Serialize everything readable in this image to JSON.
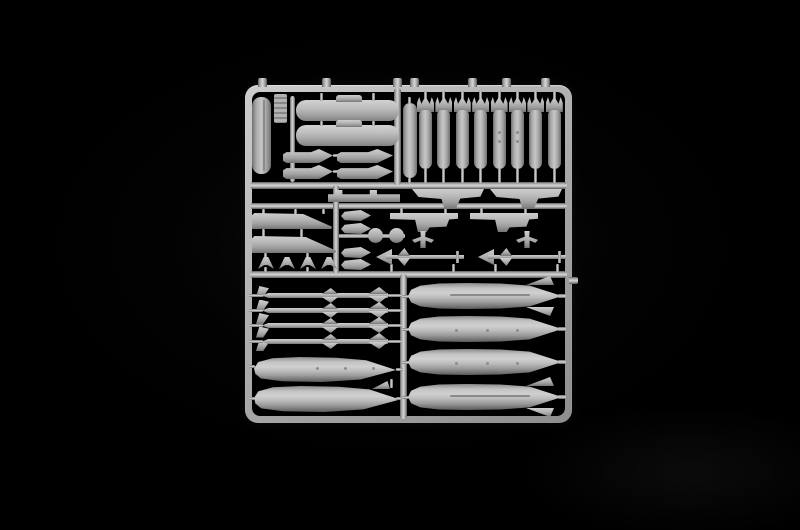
{
  "meta": {
    "subject": "Light grey injection-moulded model kit sprue of aircraft ordnance photographed on a black background",
    "description": "Parts tree containing bombs, air-to-air missiles, drop tanks, pods, launch rails and pylons for a scale aircraft model kit; no text is visible in the photograph."
  },
  "palette": {
    "background": "#000000",
    "plastic": "#b5b5b5",
    "plastic_highlight": "#d3d3d3",
    "plastic_shadow": "#5e5e5e"
  },
  "sprue": {
    "groups": {
      "strip_part": {
        "label": "vertical strip part",
        "count": 1
      },
      "ridged_tag": {
        "label": "moulding info tag",
        "count": 1
      },
      "pods": {
        "label": "elongated pod halves",
        "count": 2
      },
      "launch_rails": {
        "label": "missile launch rails",
        "count": 4
      },
      "tall_pylon": {
        "label": "tall vertical pylon part",
        "count": 1
      },
      "bombs": {
        "label": "finned bombs",
        "count": 8
      },
      "swept_pylons": {
        "label": "swept wing pylons",
        "count": 2
      },
      "flat_bar": {
        "label": "flat mounting bar",
        "count": 1
      },
      "tapered_pylons": {
        "label": "tapered wing pylons",
        "count": 2
      },
      "adapters": {
        "label": "small pylon adapters",
        "count": 4
      },
      "slab_pylons": {
        "label": "slab pylons with braces",
        "count": 2
      },
      "discs": {
        "label": "round cap parts",
        "count": 2
      },
      "sway_braces": {
        "label": "sway brace parts",
        "count": 2
      },
      "finned_missiles": {
        "label": "long finned missiles",
        "count": 2
      },
      "chevrons": {
        "label": "small fin pairs",
        "count": 4
      },
      "small_fins": {
        "label": "small missile fins",
        "count": 5
      },
      "missiles": {
        "label": "air-to-air missiles",
        "count": 4
      },
      "small_tanks": {
        "label": "slim drop tank halves",
        "count": 2
      },
      "large_tanks": {
        "label": "large drop tank halves",
        "count": 4
      },
      "frame_tabs": {
        "label": "runner attachment tabs",
        "count": 8
      }
    }
  }
}
